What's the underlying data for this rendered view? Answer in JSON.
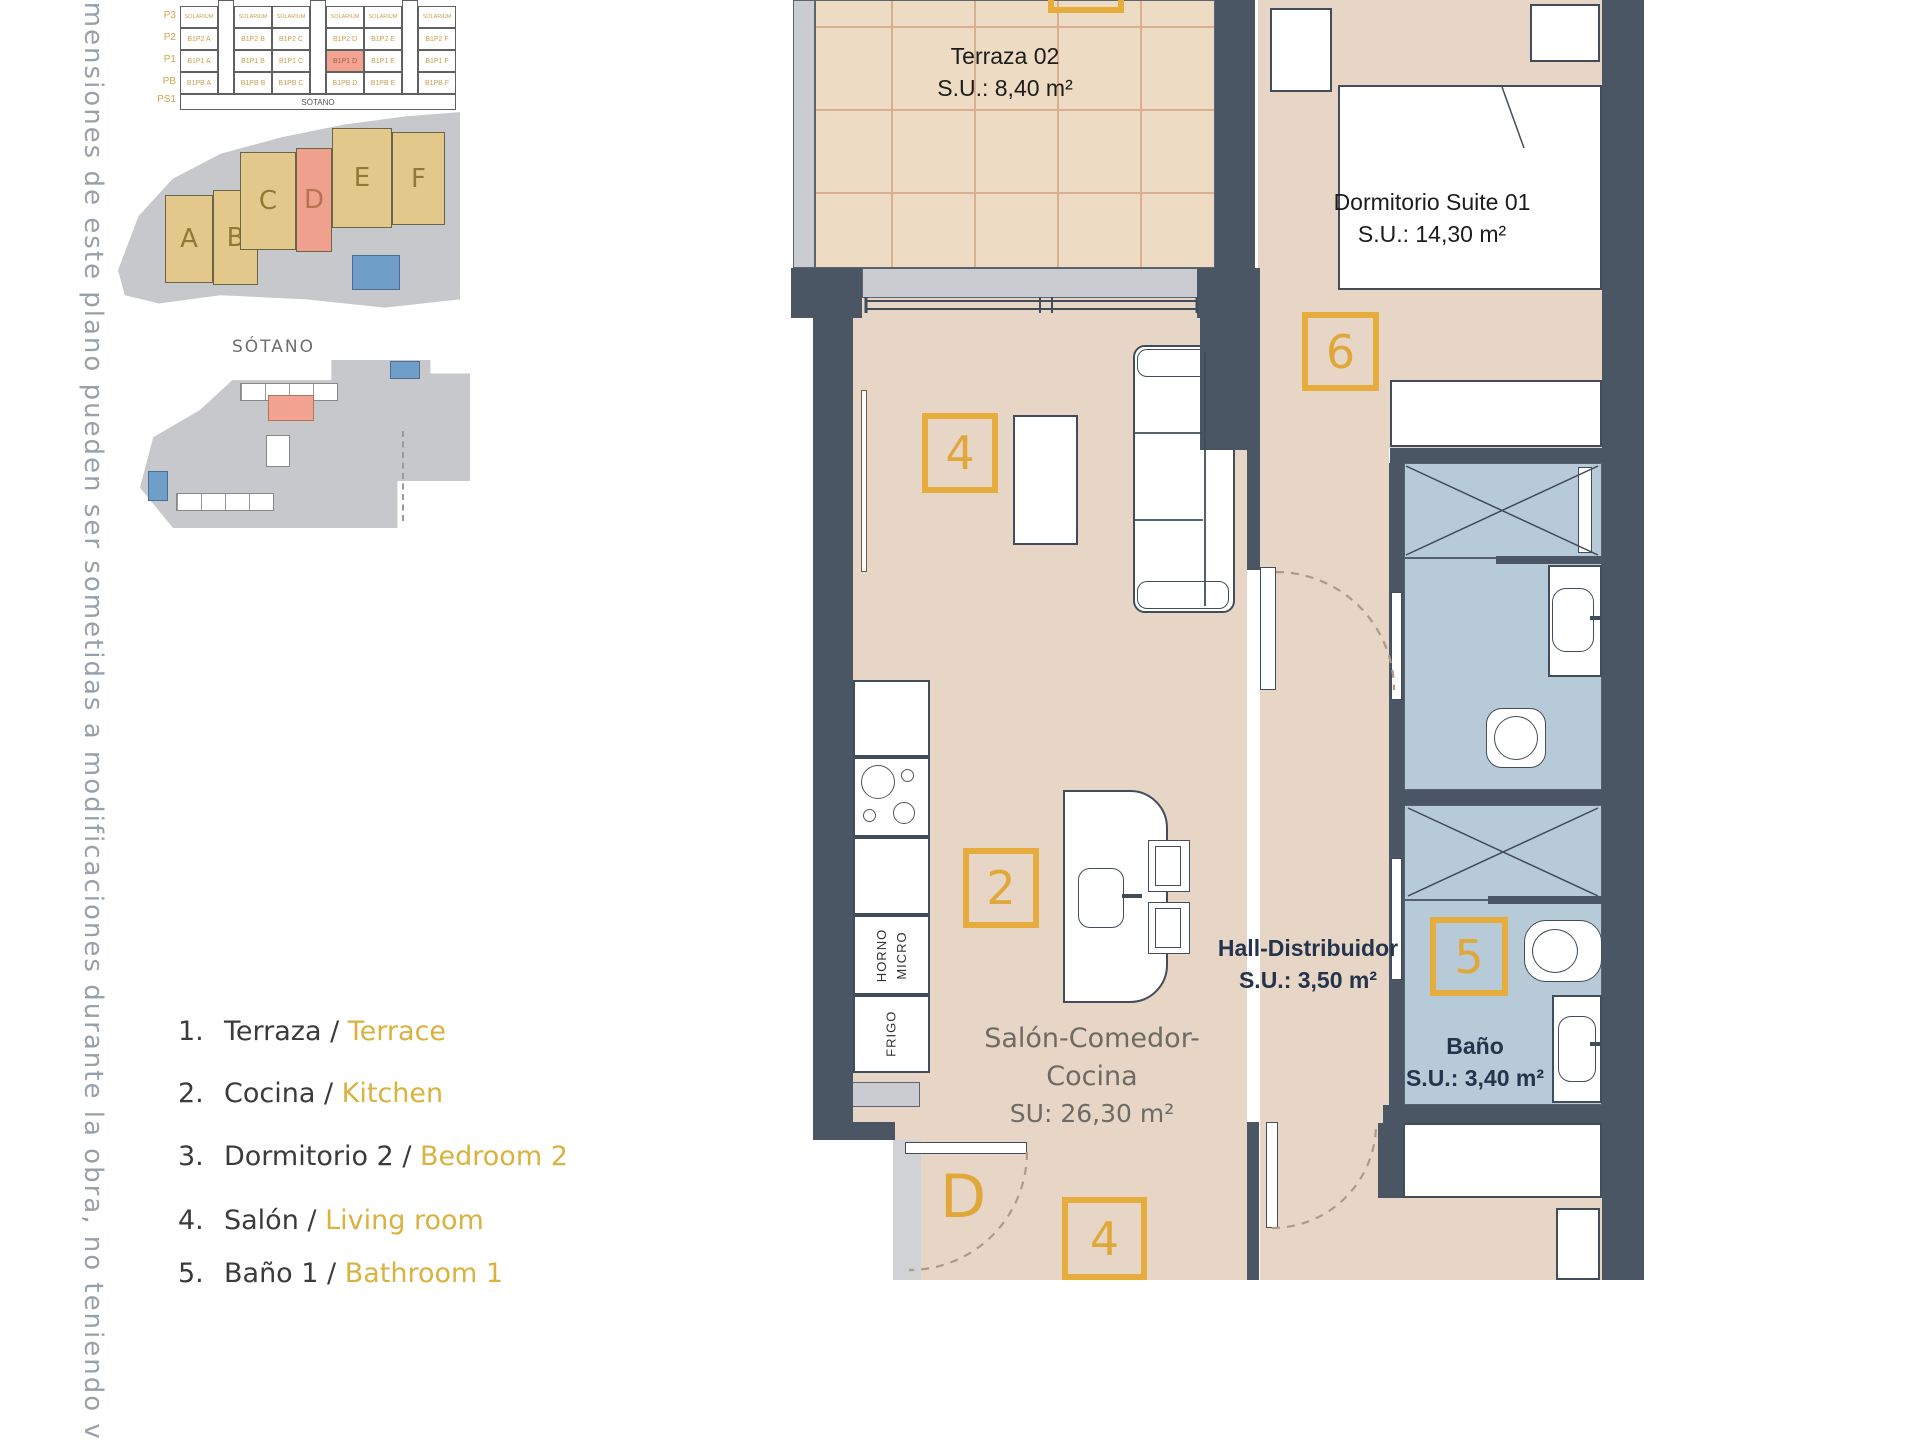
{
  "side_note": "dimensiones de este plano pueden ser sometidas a modificaciones durante la obra, no teniendo v",
  "section_diagram": {
    "floors": [
      "P3",
      "P2",
      "P1",
      "PB",
      "PS1"
    ],
    "solarium": "SOLARIUM",
    "sotano": "SÓTANO",
    "units": {
      "p2": [
        "B1P2 A",
        "B1P2 B",
        "B1P2 C",
        "B1P2 D",
        "B1P2 E",
        "B1P2 F"
      ],
      "p1": [
        "B1P1 A",
        "B1P1 B",
        "B1P1 C",
        "B1P1 D",
        "B1P1 E",
        "B1P1 F"
      ],
      "pb": [
        "B1PB A",
        "B1PB B",
        "B1PB C",
        "B1PB D",
        "B1PB E",
        "B1PB F"
      ]
    },
    "highlighted_unit": "B1P1 D"
  },
  "site_plan": {
    "buildings": [
      "A",
      "B",
      "C",
      "D",
      "E",
      "F"
    ],
    "highlighted": "D"
  },
  "sotano_plan": {
    "title": "SÓTANO"
  },
  "legend": {
    "sep": " / ",
    "items": [
      {
        "num": "1.",
        "es": "Terraza",
        "en": "Terrace"
      },
      {
        "num": "2.",
        "es": "Cocina",
        "en": "Kitchen"
      },
      {
        "num": "3.",
        "es": "Dormitorio 2",
        "en": "Bedroom 2"
      },
      {
        "num": "4.",
        "es": "Salón",
        "en": "Living room"
      },
      {
        "num": "5.",
        "es": "Baño 1",
        "en": "Bathroom 1"
      }
    ]
  },
  "floor_plan": {
    "rooms": {
      "terrace": {
        "name": "Terraza 02",
        "area": "S.U.: 8,40 m²"
      },
      "suite": {
        "name": "Dormitorio Suite 01",
        "area": "S.U.: 14,30 m²"
      },
      "hall": {
        "name": "Hall-Distribuidor",
        "area": "S.U.: 3,50 m²"
      },
      "bath": {
        "name": "Baño",
        "area": "S.U.: 3,40 m²"
      },
      "salon": {
        "name": "Salón-Comedor-Cocina",
        "area": "SU: 26,30 m²"
      }
    },
    "markers": {
      "living": "4",
      "kitchen": "2",
      "suite": "6",
      "bath": "5",
      "salon_bottom": "4",
      "door_letter": "D"
    },
    "appliances": {
      "oven1": "HORNO",
      "oven2": "MICRO",
      "fridge": "FRIGO"
    }
  }
}
